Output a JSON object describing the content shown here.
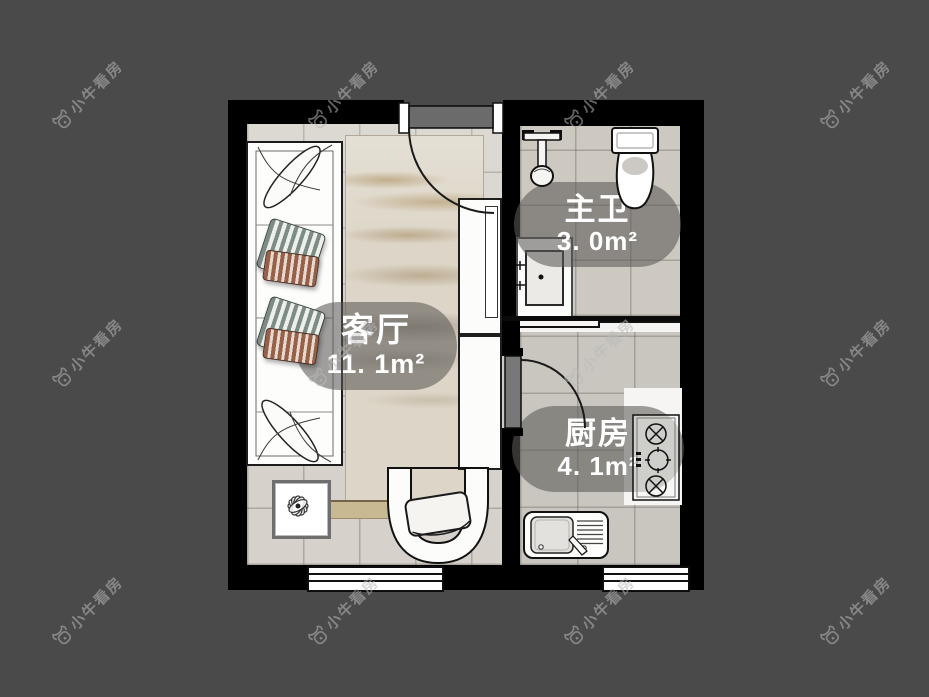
{
  "watermark": {
    "text": "小牛看房",
    "icon": "bull-icon"
  },
  "floorplan": {
    "rooms": [
      {
        "id": "living-room",
        "name": "客厅",
        "area": "11. 1m²"
      },
      {
        "id": "master-bath",
        "name": "主卫",
        "area": "3. 0m²"
      },
      {
        "id": "kitchen",
        "name": "厨房",
        "area": "4. 1m²"
      }
    ]
  },
  "colors": {
    "page_background": "#4a4a4a",
    "walls": "#000000",
    "label_pill": "rgba(92,90,86,0.58)",
    "label_text": "#ffffff",
    "watermark": "rgba(185,185,185,0.55)"
  }
}
